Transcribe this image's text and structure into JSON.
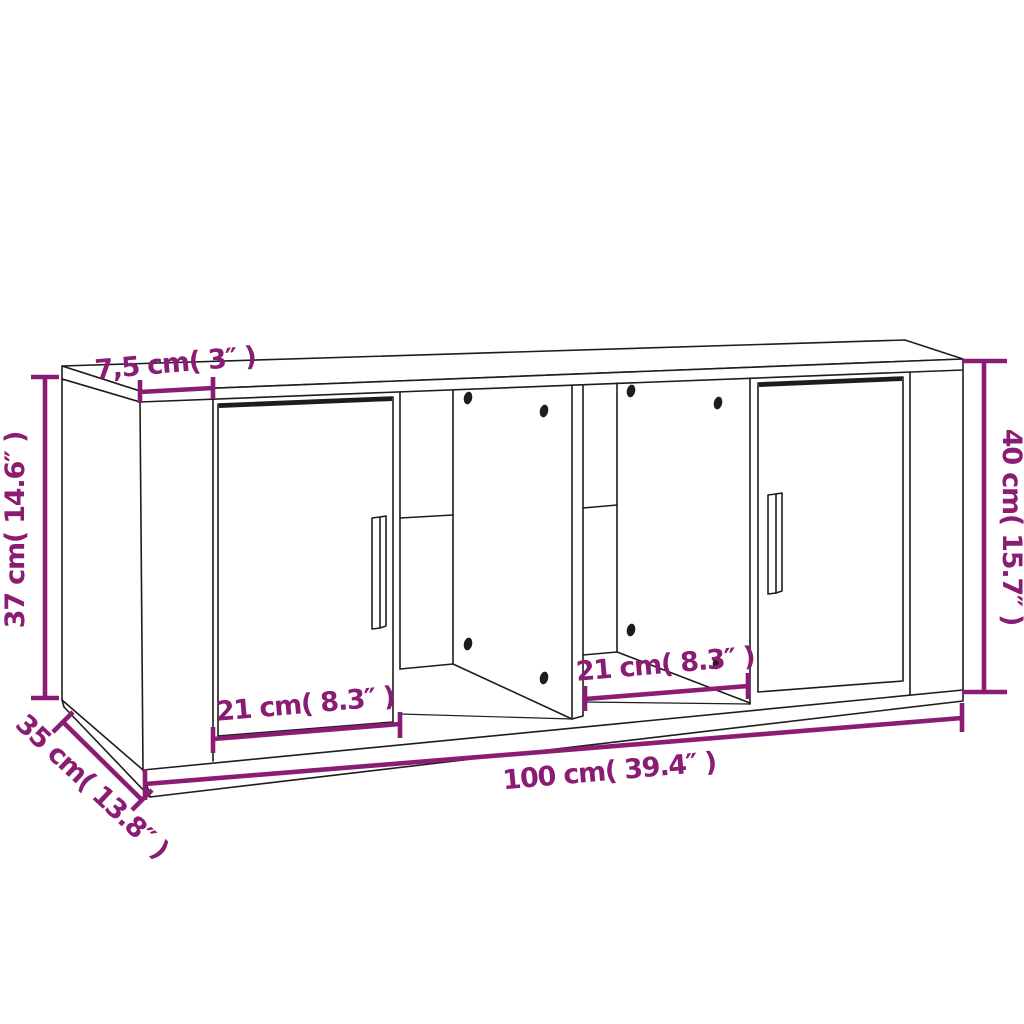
{
  "diagram": {
    "colors": {
      "dimension_accent": "#8B1C74",
      "outline": "#1D1D1B",
      "background": "#FFFFFF"
    },
    "labels": {
      "top_panel_depth": "7,5 cm( 3″ )",
      "side_height": "37 cm( 14.6″ )",
      "total_height": "40 cm( 15.7″ )",
      "depth": "35 cm( 13.8″ )",
      "width": "100 cm( 39.4″ )",
      "left_compartment_width": "21 cm( 8.3″ )",
      "right_compartment_width": "21 cm( 8.3″ )"
    }
  }
}
